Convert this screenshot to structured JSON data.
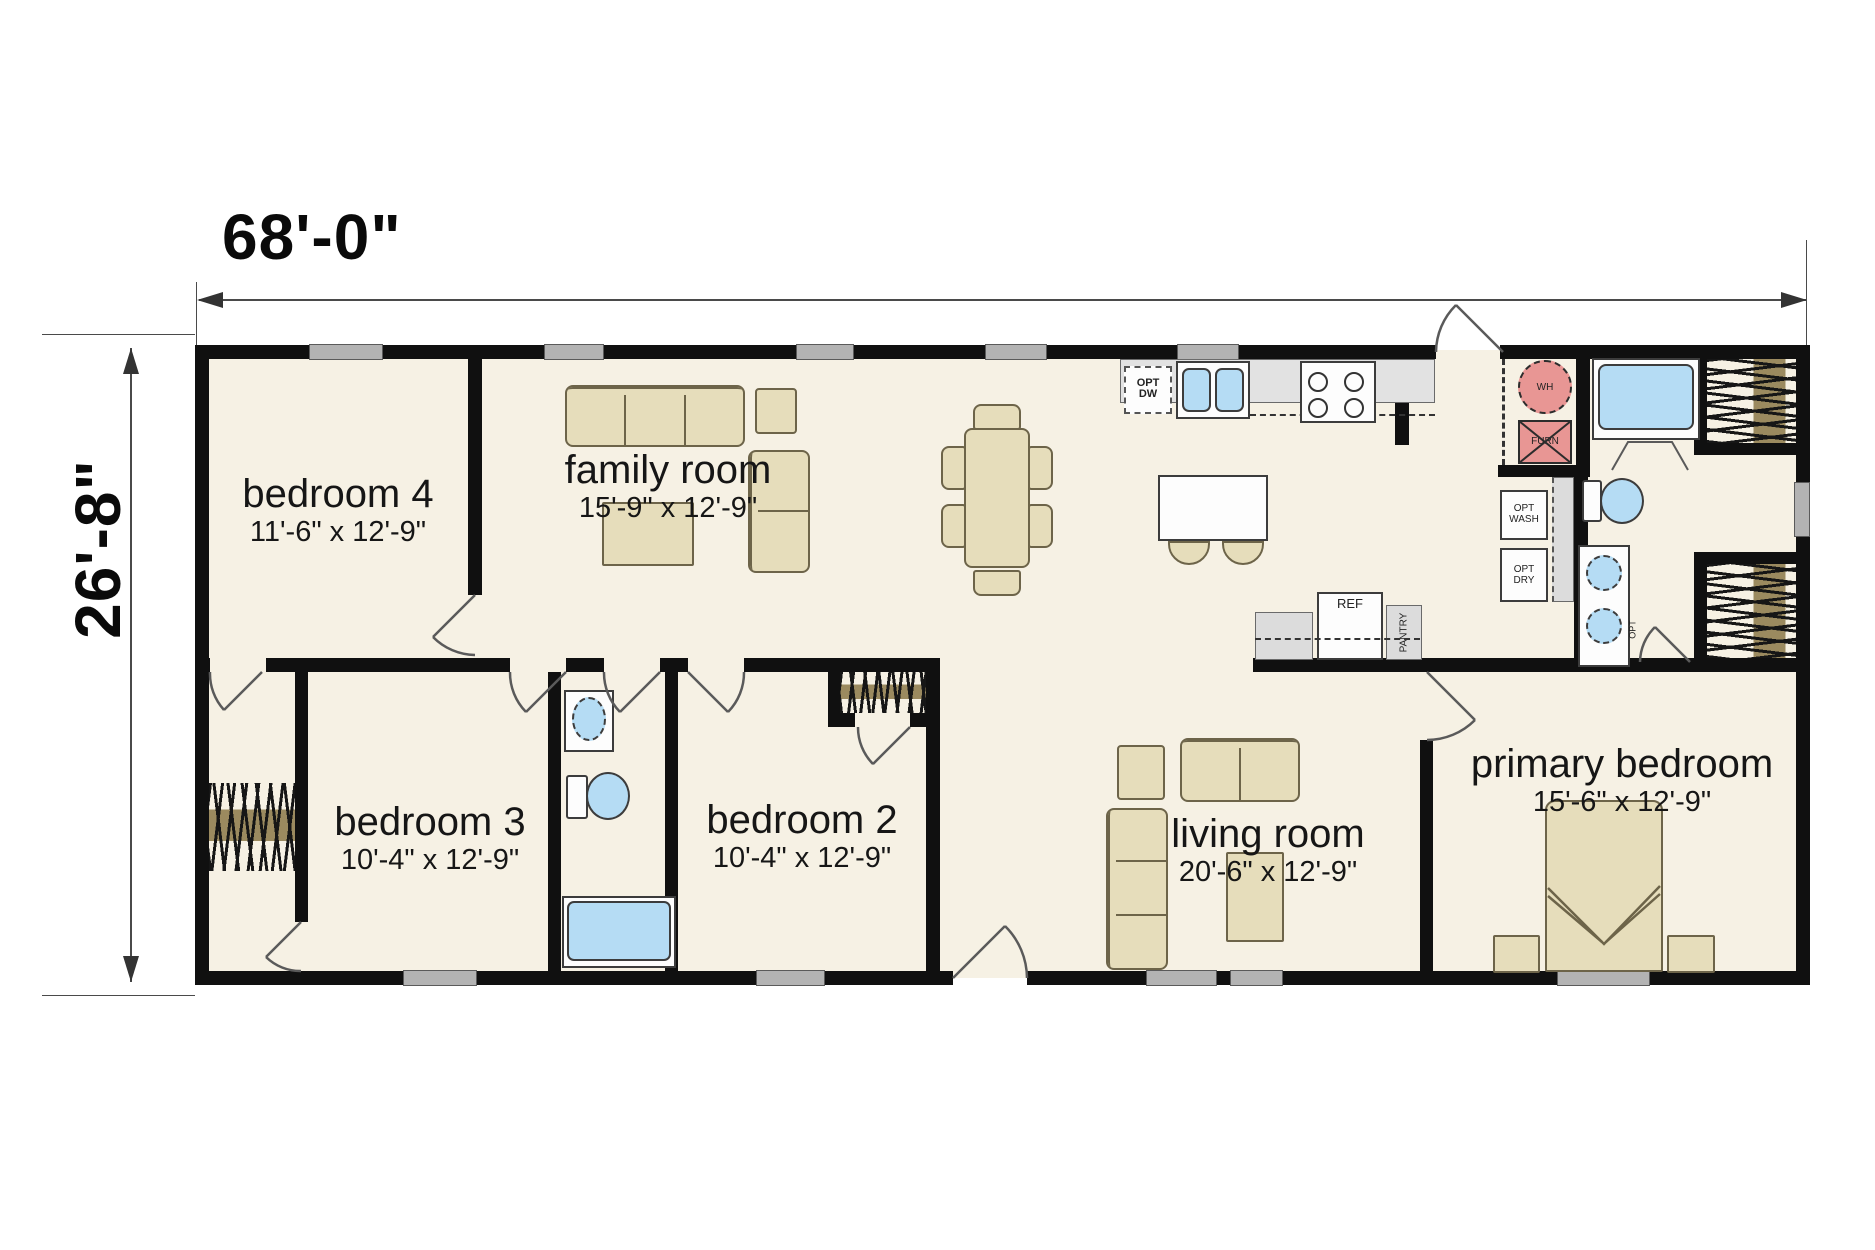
{
  "dimensions": {
    "width_label": "68'-0\"",
    "height_label": "26'-8\""
  },
  "rooms": [
    {
      "name": "bedroom 4",
      "size": "11'-6\" x 12'-9\""
    },
    {
      "name": "family room",
      "size": "15'-9\" x 12'-9\""
    },
    {
      "name": "bedroom 3",
      "size": "10'-4\" x 12'-9\""
    },
    {
      "name": "bedroom 2",
      "size": "10'-4\" x 12'-9\""
    },
    {
      "name": "living room",
      "size": "20'-6\" x 12'-9\""
    },
    {
      "name": "primary bedroom",
      "size": "15'-6\" x 12'-9\""
    }
  ],
  "kitchen": {
    "opt_dw": "OPT DW",
    "ref": "REF",
    "pantry": "PANTRY"
  },
  "utility": {
    "wh": "WH",
    "furn": "FURN",
    "opt_wash": "OPT WASH",
    "opt_dry": "OPT DRY",
    "opt_door": "OPT"
  },
  "colors": {
    "floor": "#f6f1e4",
    "wall": "#101010",
    "furniture_tan": "#e6ddbb",
    "fixture_blue": "#b5dcf4",
    "equipment_pink": "#e89694",
    "counter_gray": "#dcdcdc",
    "window_gray": "#b3b3b3",
    "closet_rod_brown": "#9b8a5f"
  }
}
